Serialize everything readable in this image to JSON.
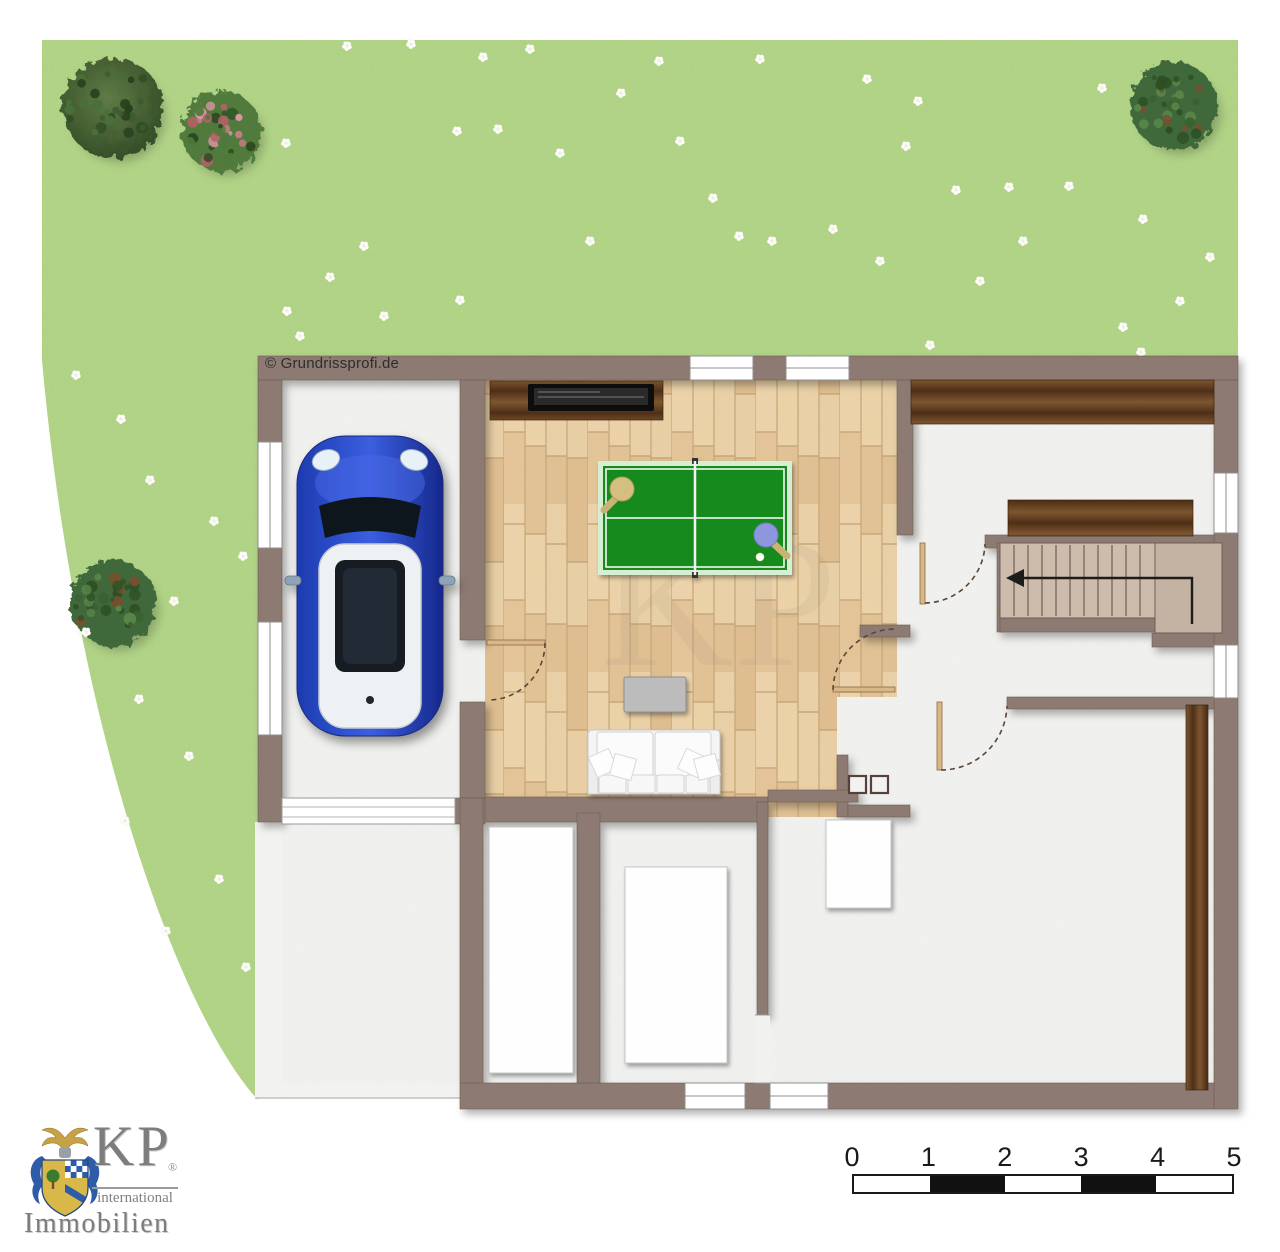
{
  "meta": {
    "copyright": "© Grundrissprofi.de"
  },
  "watermark": {
    "text": "KP"
  },
  "branding": {
    "monogram": "KP",
    "registered": "®",
    "subtitle": "international",
    "company": "Immobilien"
  },
  "scale_bar": {
    "labels": [
      "0",
      "1",
      "2",
      "3",
      "4",
      "5"
    ],
    "segments": [
      "white",
      "black",
      "white",
      "black",
      "white"
    ]
  },
  "colors": {
    "lawn": "#a9ce7c",
    "wall": "#8d7a72",
    "wood_floor": "#e6c89c",
    "dark_wood": "#6b4a26",
    "room_floor": "#f1f1ef",
    "terrace": "#f4f4f2",
    "table_tennis_green": "#178a1f",
    "paddle_tan": "#d4be80",
    "paddle_blue": "#8e96dd",
    "car_blue": "#2443b8",
    "stair_tread": "#cdbcab",
    "scale_black": "#111111",
    "logo_gray": "#7f7f7f",
    "crest_blue": "#2e5ca8",
    "crest_gold": "#d9b84a"
  },
  "garden": {
    "trees": [
      {
        "name": "tree",
        "type": "dark",
        "x": 113,
        "y": 108,
        "r": 50
      },
      {
        "name": "bush",
        "type": "pink",
        "x": 221,
        "y": 131,
        "r": 40
      },
      {
        "name": "bush",
        "type": "leafy",
        "x": 113,
        "y": 603,
        "r": 43
      },
      {
        "name": "bush",
        "type": "leafy",
        "x": 1174,
        "y": 106,
        "r": 44
      }
    ],
    "flowers": [
      [
        347,
        46
      ],
      [
        411,
        44
      ],
      [
        483,
        57
      ],
      [
        530,
        49
      ],
      [
        457,
        131
      ],
      [
        498,
        129
      ],
      [
        560,
        153
      ],
      [
        621,
        93
      ],
      [
        659,
        61
      ],
      [
        760,
        59
      ],
      [
        713,
        198
      ],
      [
        739,
        236
      ],
      [
        772,
        241
      ],
      [
        833,
        229
      ],
      [
        867,
        79
      ],
      [
        906,
        146
      ],
      [
        918,
        101
      ],
      [
        956,
        190
      ],
      [
        1009,
        187
      ],
      [
        1023,
        241
      ],
      [
        1102,
        88
      ],
      [
        1069,
        186
      ],
      [
        1143,
        219
      ],
      [
        1210,
        257
      ],
      [
        1123,
        327
      ],
      [
        930,
        345
      ],
      [
        1141,
        352
      ],
      [
        287,
        311
      ],
      [
        300,
        336
      ],
      [
        384,
        316
      ],
      [
        364,
        246
      ],
      [
        330,
        277
      ],
      [
        286,
        143
      ],
      [
        460,
        300
      ],
      [
        590,
        241
      ],
      [
        680,
        141
      ],
      [
        980,
        281
      ],
      [
        880,
        261
      ],
      [
        1180,
        301
      ],
      [
        76,
        375
      ],
      [
        121,
        419
      ],
      [
        150,
        480
      ],
      [
        214,
        521
      ],
      [
        243,
        556
      ],
      [
        174,
        601
      ],
      [
        86,
        632
      ],
      [
        139,
        699
      ],
      [
        189,
        756
      ],
      [
        125,
        821
      ],
      [
        219,
        879
      ],
      [
        166,
        931
      ],
      [
        246,
        967
      ]
    ]
  }
}
